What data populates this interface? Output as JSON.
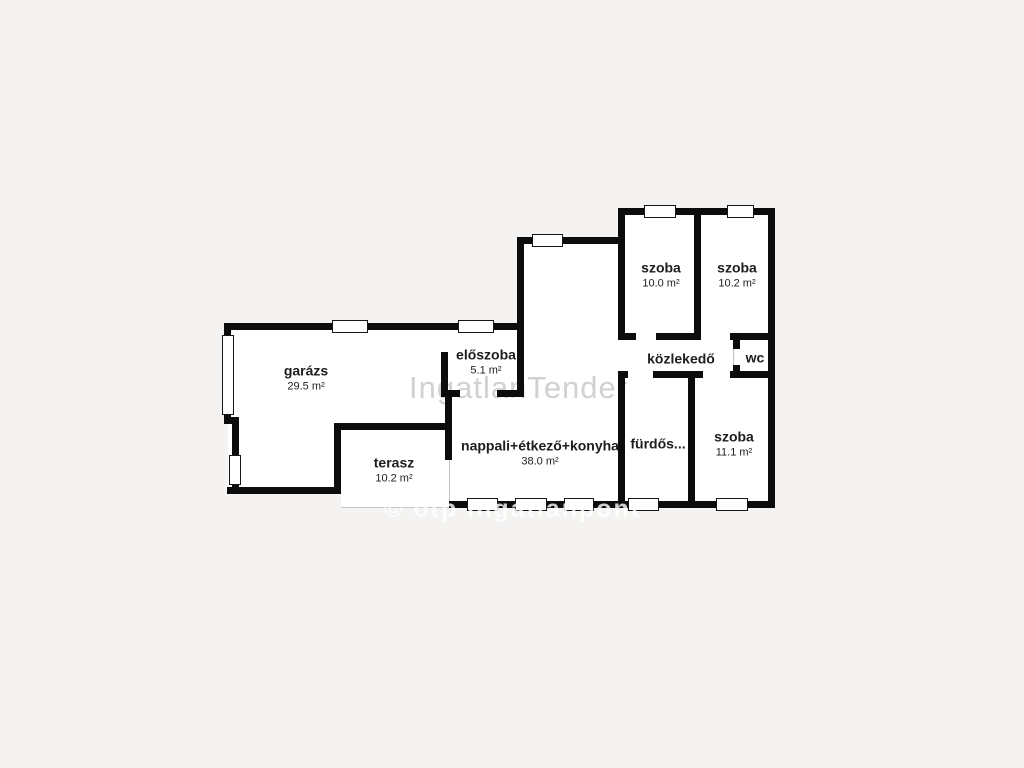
{
  "plan": {
    "watermark_center": "IngatlanTender",
    "watermark_bottom": "© otp ingatlanpont",
    "rooms": [
      {
        "id": "garazs",
        "name": "garázs",
        "area": "29.5 m²"
      },
      {
        "id": "eloszoba",
        "name": "előszoba",
        "area": "5.1 m²"
      },
      {
        "id": "terasz",
        "name": "terasz",
        "area": "10.2 m²"
      },
      {
        "id": "nappali",
        "name": "nappali+étkező+konyha",
        "area": "38.0 m²"
      },
      {
        "id": "szoba-1",
        "name": "szoba",
        "area": "10.0 m²"
      },
      {
        "id": "szoba-2",
        "name": "szoba",
        "area": "10.2 m²"
      },
      {
        "id": "kozlekedo",
        "name": "közlekedő",
        "area": ""
      },
      {
        "id": "wc",
        "name": "wc",
        "area": ""
      },
      {
        "id": "furdoszoba",
        "name": "fürdős...",
        "area": ""
      },
      {
        "id": "szoba-3",
        "name": "szoba",
        "area": "11.1 m²"
      }
    ],
    "colors": {
      "background": "#f4f3f1",
      "wall": "#0c0c0c",
      "floor": "#ffffff",
      "label_text": "#1d1d1d",
      "watermark_center_color": "#d1d1d1",
      "watermark_bottom_color": "rgba(255,255,255,0.8)"
    }
  }
}
